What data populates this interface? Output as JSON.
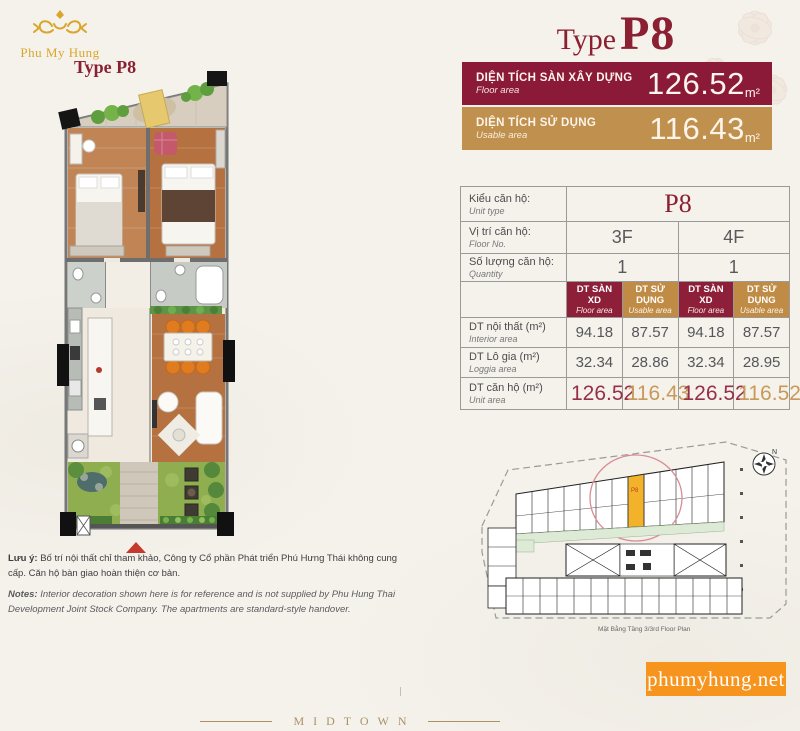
{
  "logo": {
    "brand": "Phu My Hung"
  },
  "plan": {
    "label": "Type P8"
  },
  "title": {
    "prefix": "Type",
    "code": "P8"
  },
  "banners": [
    {
      "label_vi": "DIỆN TÍCH SÀN XÂY DỰNG",
      "label_en": "Floor area",
      "value": "126.52",
      "unit": "m²",
      "color": "#8A1A38"
    },
    {
      "label_vi": "DIỆN TÍCH SỬ DỤNG",
      "label_en": "Usable area",
      "value": "116.43",
      "unit": "m²",
      "color": "#C0914E"
    }
  ],
  "table": {
    "unit_type": {
      "vi": "Kiểu căn hộ:",
      "en": "Unit type",
      "value": "P8"
    },
    "floor_no": {
      "vi": "Vị trí căn hộ:",
      "en": "Floor No.",
      "values": [
        "3F",
        "4F"
      ]
    },
    "quantity": {
      "vi": "Số lượng căn hộ:",
      "en": "Quantity",
      "values": [
        "1",
        "1"
      ]
    },
    "col_headers": [
      {
        "vi": "DT SÀN XD",
        "en": "Floor area"
      },
      {
        "vi": "DT SỬ DỤNG",
        "en": "Usable area"
      },
      {
        "vi": "DT SÀN XD",
        "en": "Floor area"
      },
      {
        "vi": "DT SỬ DỤNG",
        "en": "Usable area"
      }
    ],
    "interior": {
      "vi": "DT nội thất (m²)",
      "en": "Interior area",
      "values": [
        "94.18",
        "87.57",
        "94.18",
        "87.57"
      ]
    },
    "loggia": {
      "vi": "DT Lô gia (m²)",
      "en": "Loggia area",
      "values": [
        "32.34",
        "28.86",
        "32.34",
        "28.95"
      ]
    },
    "unit_area": {
      "vi": "DT căn hộ (m²)",
      "en": "Unit area",
      "values": [
        "126.52",
        "116.43",
        "126.52",
        "116.52"
      ]
    }
  },
  "site_plan": {
    "caption": "Mặt Bằng Tầng 3/3rd Floor Plan",
    "compass": "N",
    "unit_label": "P8"
  },
  "notes": {
    "vi_label": "Lưu ý:",
    "vi_text": " Bố trí nội thất chỉ tham khảo, Công ty Cổ phần Phát triển Phú Hưng Thái không cung cấp. Căn hộ bàn giao hoàn thiện cơ bản.",
    "en_label": "Notes:",
    "en_text": " Interior decoration shown here is for reference and is not supplied by Phu Hung Thai Development Joint Stock Company. The apartments are standard-style handover."
  },
  "website": {
    "label": "phumyhung.net"
  },
  "footer": {
    "brand": "MIDTOWN"
  },
  "colors": {
    "maroon": "#8A1A38",
    "gold": "#C0914E",
    "orange": "#F7941D",
    "title_red": "#8A2031",
    "highlight_yellow": "#F2B32A"
  }
}
